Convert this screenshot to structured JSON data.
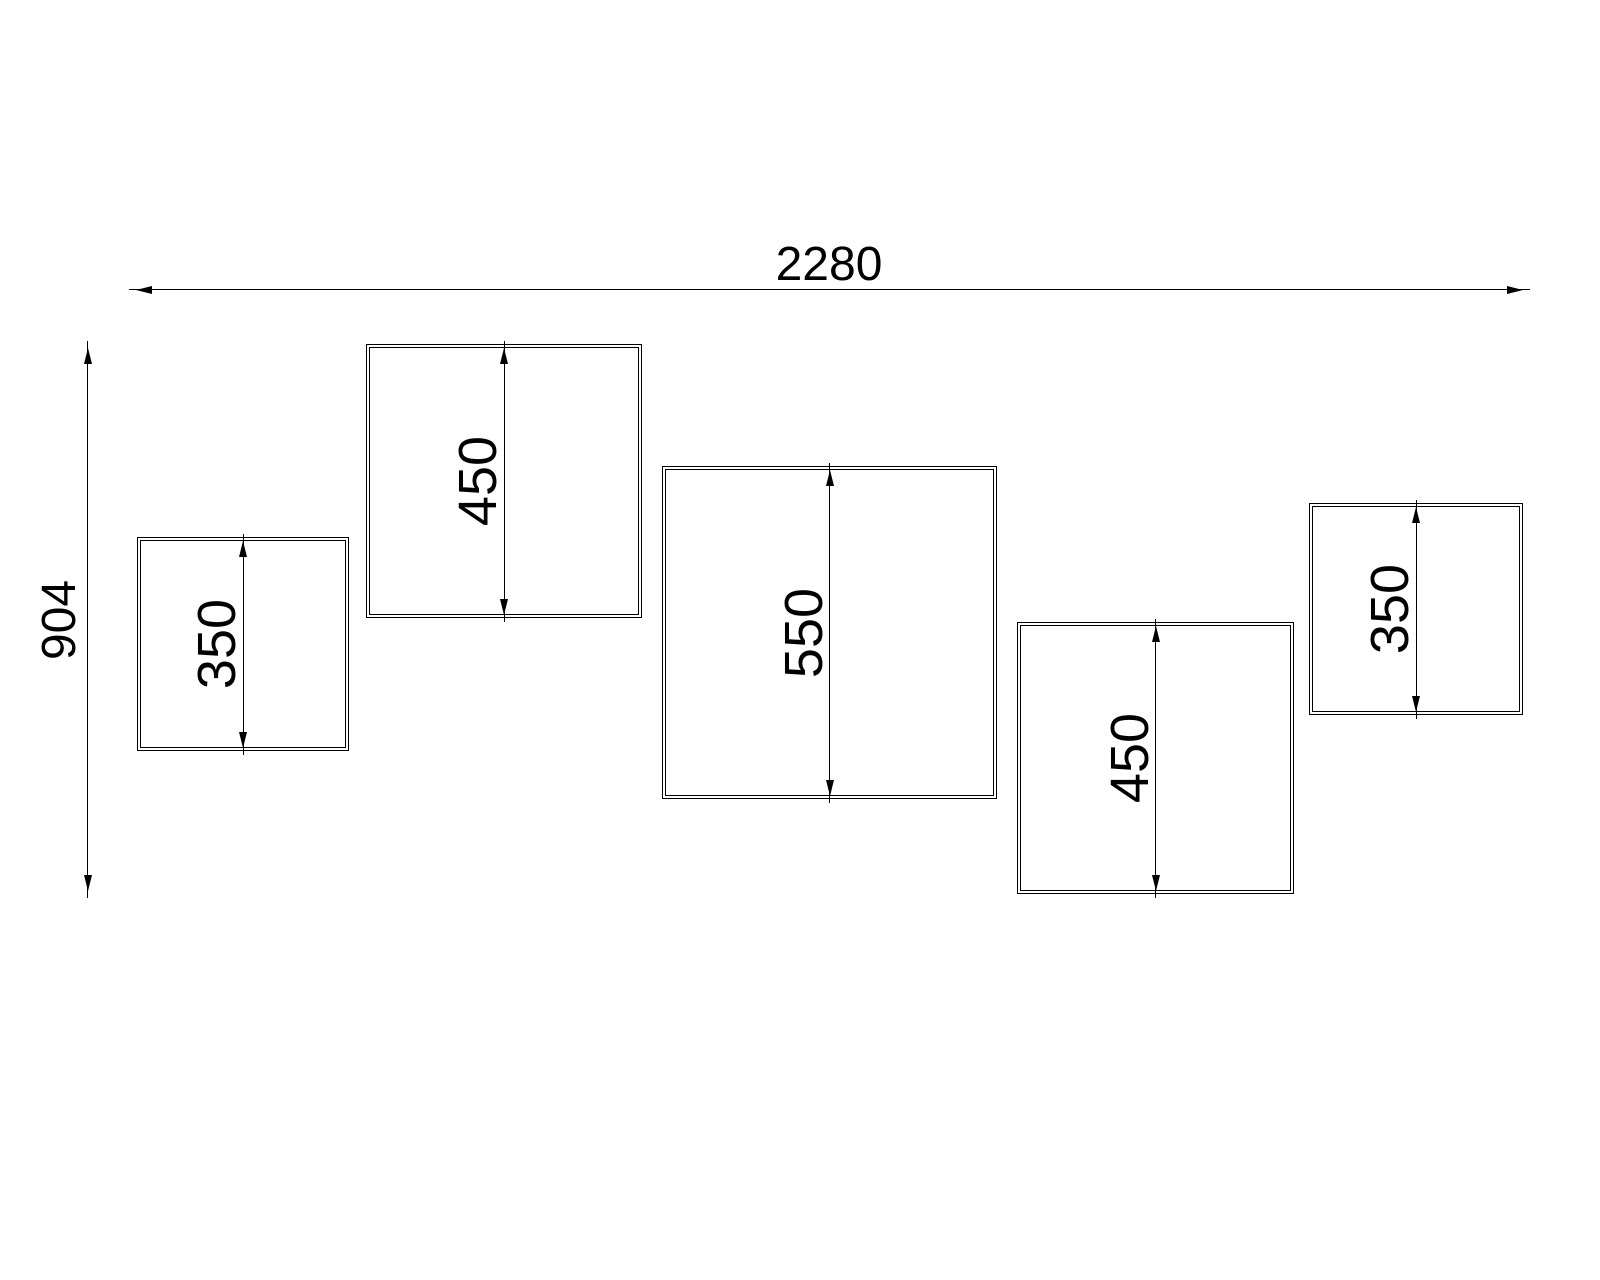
{
  "drawing": {
    "overall": {
      "width_label": "2280",
      "width_value": 2280,
      "height_label": "904",
      "height_value": 904
    },
    "panels": [
      {
        "height_label": "350",
        "height_value": 350
      },
      {
        "height_label": "450",
        "height_value": 450
      },
      {
        "height_label": "550",
        "height_value": 550
      },
      {
        "height_label": "450",
        "height_value": 450
      },
      {
        "height_label": "350",
        "height_value": 350
      }
    ],
    "line_color": "#000000",
    "background_color": "#ffffff"
  }
}
